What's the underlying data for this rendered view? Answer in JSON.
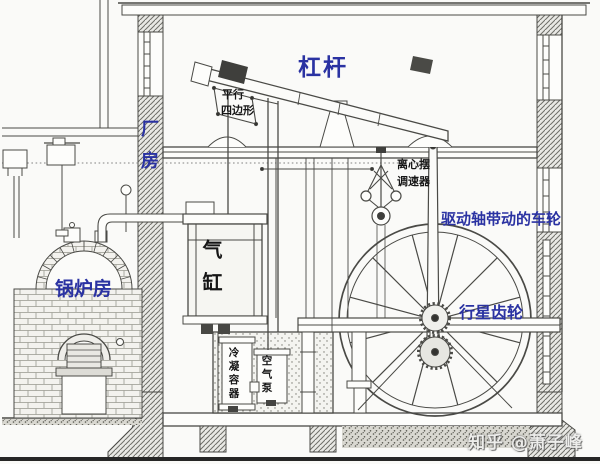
{
  "labels": {
    "lever": "杠杆",
    "parallelogram_line1": "平行",
    "parallelogram_line2": "四边形",
    "factory_building": "厂房",
    "governor_line1": "离心摆",
    "governor_line2": "调速器",
    "drive_shaft_wheel": "驱动轴带动的车轮",
    "cylinder": "气缸",
    "boiler_room": "锅炉房",
    "planetary_gear": "行星齿轮",
    "condenser": "冷凝容器",
    "air_pump": "空气泵"
  },
  "watermark": "知乎 @萧子峰",
  "colors": {
    "label_blue": "#2a32a2",
    "label_black": "#161616",
    "line_ink": "#4a4a46",
    "paper": "#fafaf8",
    "watermark_gray": "#ededeb"
  }
}
